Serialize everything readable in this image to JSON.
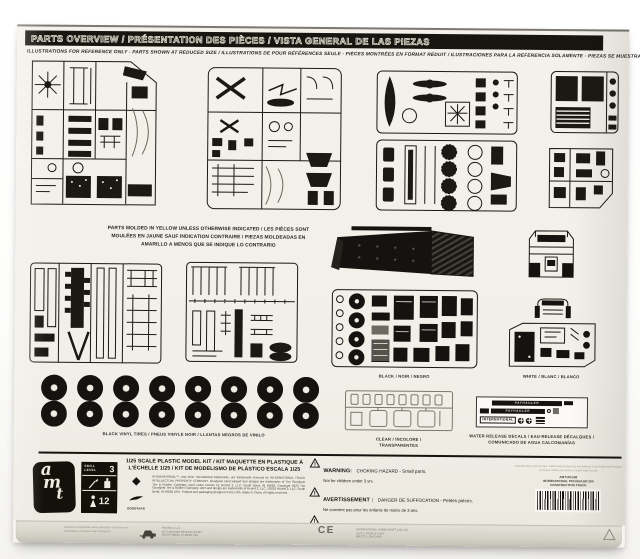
{
  "header": {
    "title": "PARTS OVERVIEW / PRÉSENTATION DES PIÈCES / VISTA GENERAL DE LAS PIEZAS",
    "subtitle": "ILLUSTRATIONS FOR REFERENCE ONLY - PARTS SHOWN AT REDUCED SIZE / ILLUSTRATIONS DE POUR RÉFÉRENCES SEULE - PIÈCES MONTRÉES EN FORMAT RÉDUIT / ILUSTRACIONES PARA LA REFERENCIA SOLAMENTE - PIEZAS SE MUESTRAN EN TAMAÑO REDUCIDO"
  },
  "molded_note": {
    "line1": "PARTS MOLDED IN YELLOW UNLESS OTHERWISE INDICATED / LES PIÈCES SONT",
    "line2": "MOULÉES EN JAUNE SAUF INDICATION CONTRAIRE / PIEZAS MOLDEADAS EN",
    "line3": "AMARILLO A MENOS QUE SE INDIQUE LO CONTRARIO"
  },
  "labels": {
    "black": "BLACK / NOIR / NEGRO",
    "white": "WHITE / BLANC / BLANCO",
    "tires": "BLACK VINYL TIRES / PNEUS VINYLE NOIR / LLANTAS NEGROS DE VINILO",
    "clear": "CLEAR / INCOLORE / TRANSPARENTES",
    "decals": "WATER RELEASE DECALS / EAU-RELEASE DÉCALQUES / COMUNICADO DE AGUA CALCOMANÍAS"
  },
  "decal_sheet": {
    "row1": "PAYHAULER",
    "row2": "PAYHAULER",
    "row3": "INTERNATIONAL"
  },
  "footer": {
    "scale_text": "1/25 SCALE PLASTIC MODEL KIT / KIT MAQUETTE EN PLASTIQUE À L'ÉCHELLE 1/25 / KIT DE MODELISMO DE PLÁSTICO ESCALA 1/25",
    "legal": "INTERNATIONAL™, and other International trademarks, are trademarks licensed by INTERNATIONAL TRUCK INTELLECTUAL PROPERTY COMPANY. Goodyear (and winged foot design) are trademarks of The Goodyear Tire & Rubber Company used under license by Round 2, LLC, South Bend, IN 46628. Copyright 2023 The Goodyear Tire & Rubber Company. AMT and design are trademarks of Round 2, LLC. ©2023 Round 2, LLC, South Bend, IN 46628 USA. Product and packaging designed in the USA. Made in China. All rights reserved.",
    "goodyear": "GOODYEAR",
    "amt": {
      "l1": "a",
      "l2": "m",
      "l3": "t"
    },
    "skill": {
      "label1": "SKILL",
      "label2": "LEVEL",
      "number": "3",
      "ages": "12"
    },
    "warnings": [
      {
        "heading": "WARNING:",
        "body": "CHOKING HAZARD - Small parts.",
        "sub": "Not for children under 3 yrs."
      },
      {
        "heading": "AVERTISSEMENT :",
        "body": "DANGER DE SUFFOCATION - Petites pièces.",
        "sub": "Ne convient pas pour les enfants de moins de 3 ans."
      },
      {
        "heading": "ADVERTENCIA:",
        "body": "PELIGRO DE ASFIXIA - Contiene piezas pequeñas.",
        "sub": "No apto para niños menores de 3 años."
      }
    ],
    "right_fine_print": "Manufactured under license. Trademarks licensed by International Truck Intellectual Property Company. Utilisé sous licence. Usado bajo licencia.",
    "product": {
      "sku": "AMT1301/08",
      "line1": "INTERNATIONAL PAYHAULER 350",
      "line2": "CONSTRUCTION TRUCK"
    }
  },
  "bottom_edge": {
    "left_lines": "Conforms to applicable safety standards. Conserver ces informations. Conserve esta información.",
    "maker_line1": "ROUND 2, LLC",
    "maker_line2": "4073 MEGHAN BEELER COURT",
    "maker_line3": "SOUTH BEND, IN 46628 USA",
    "ce": "CE",
    "right_line1": "INTERNATIONAL HOBBYCRAFT (UK) LTD.",
    "right_line2": "UNIT 2, TEMPLE GATE",
    "right_line3": "BRISTOL, ENGLAND"
  }
}
